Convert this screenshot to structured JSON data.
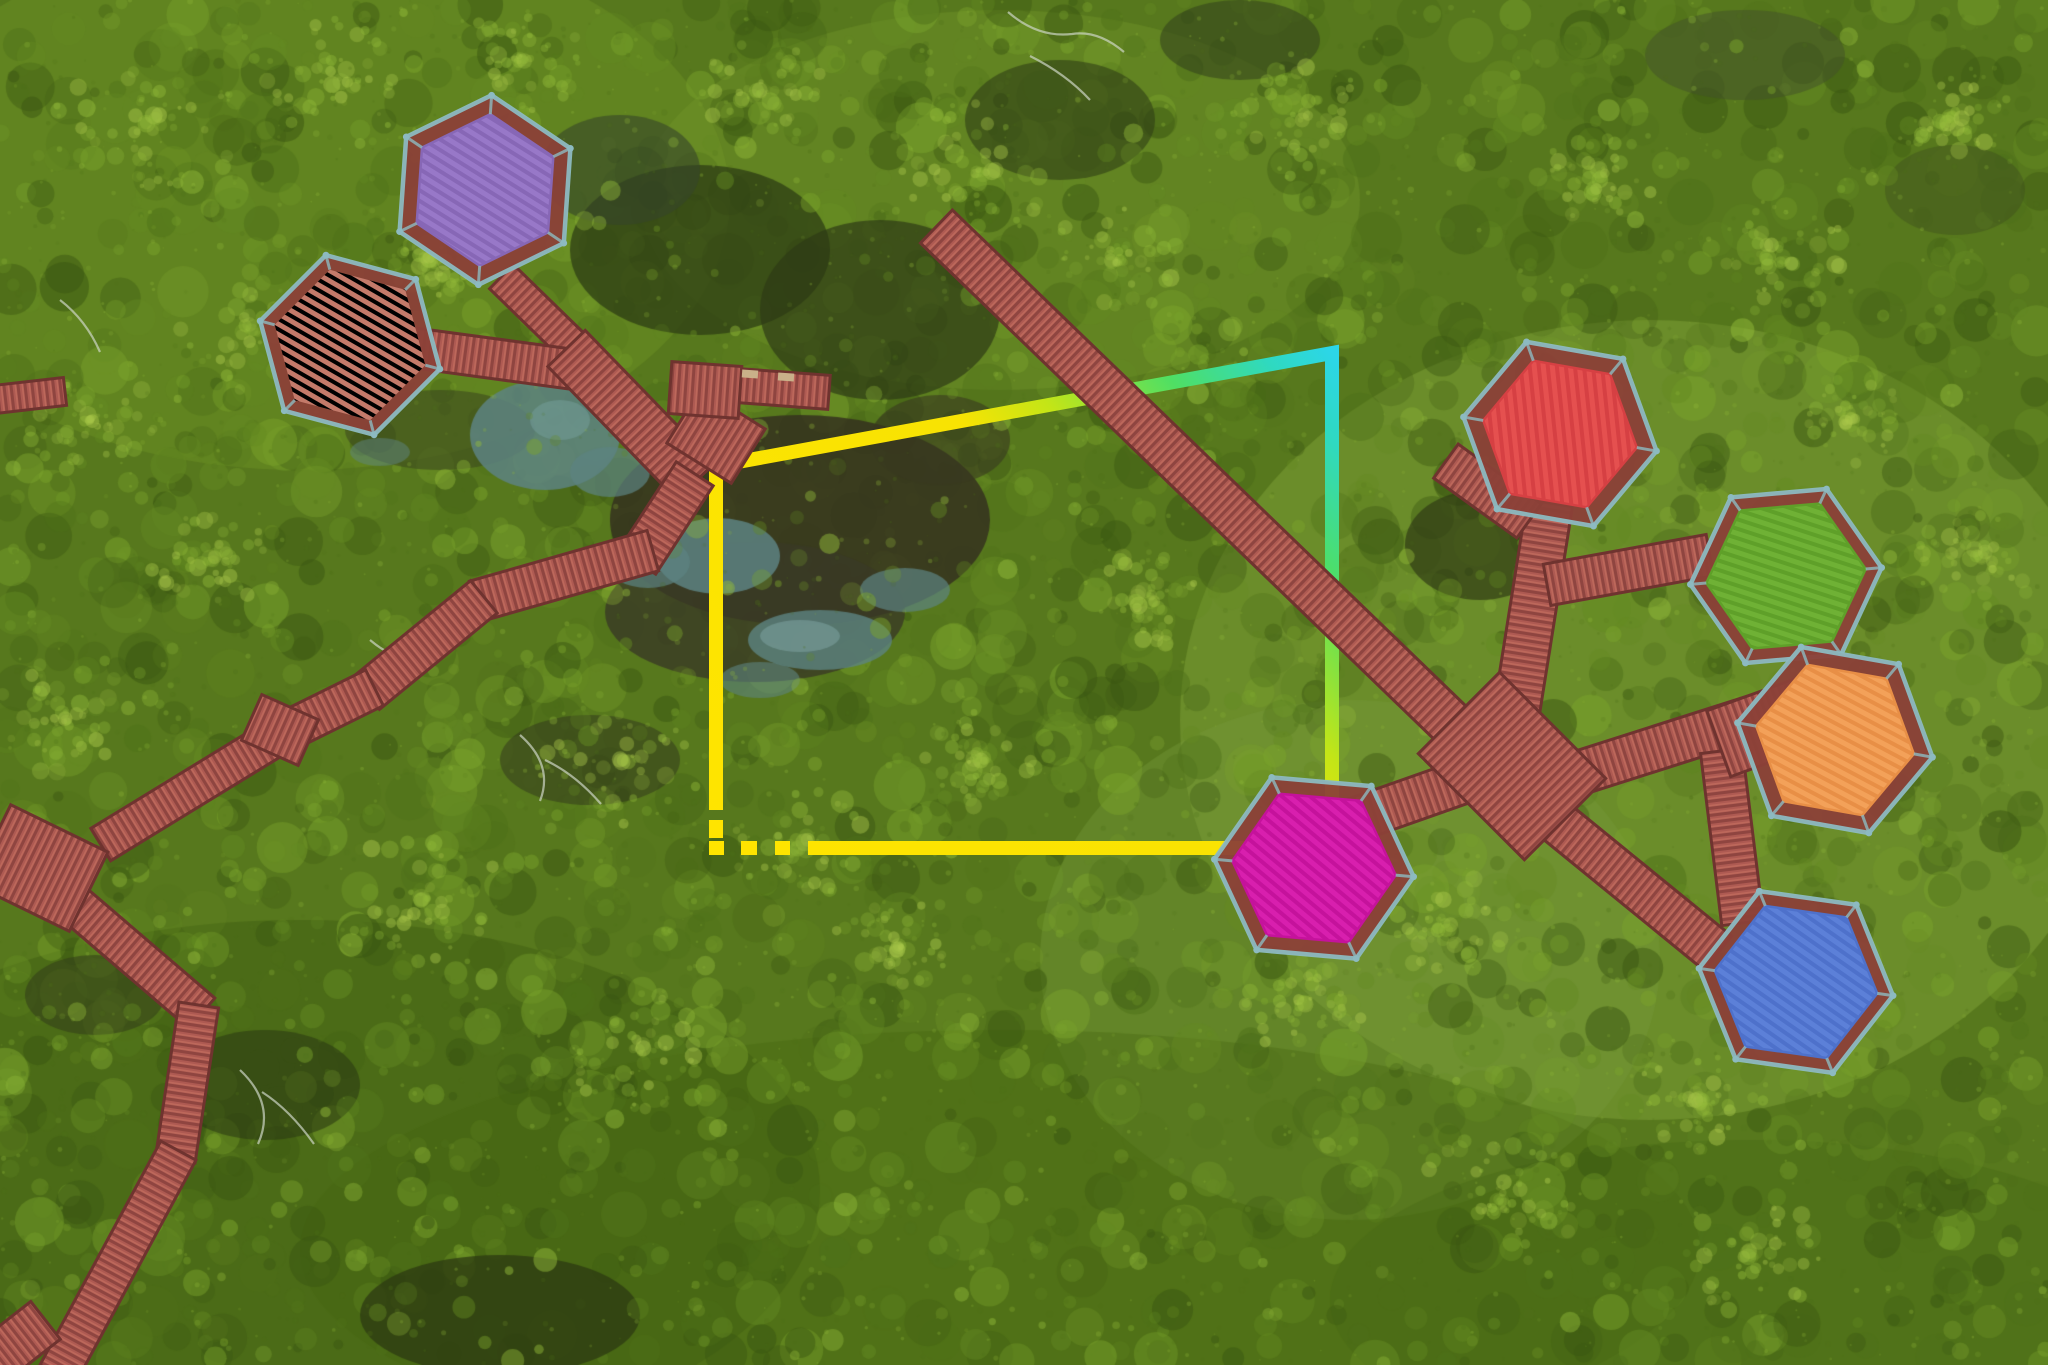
{
  "scene": {
    "type": "aerial-drone-photo",
    "subject": "Mangrove forest park with seven hexagonal viewing pavilions connected by red wooden boardwalks, partially outlined by a yellow-to-cyan selection rectangle",
    "width": 2048,
    "height": 1365
  },
  "annotation": {
    "shape": "rectangle-outline",
    "stroke_width": 14,
    "solid_path": "M 716,810 L 716,466 L 1332,353 L 1332,812",
    "corner_dash": {
      "x": 709,
      "y": 820,
      "w": 14,
      "h": 18
    },
    "dashed_path": "M 709,848 L 1252,848",
    "dash_pattern": "15 17 16 18 15 18 600",
    "gradient": {
      "from": [
        716,
        848
      ],
      "to": [
        1332,
        353
      ],
      "stops": [
        [
          0.0,
          "#ffe400"
        ],
        [
          0.58,
          "#f8e303"
        ],
        [
          0.68,
          "#c3e517"
        ],
        [
          0.82,
          "#4fdf64"
        ],
        [
          0.93,
          "#2fd9c0"
        ],
        [
          1.0,
          "#2cd6e8"
        ]
      ]
    }
  },
  "pavilions": [
    {
      "id": "purple",
      "roof_color": "#9878c8",
      "stripe_color": "#8767b6"
    },
    {
      "id": "salmon",
      "roof_color": "#c47a6a",
      "stripe_color": "#b16а5c"
    },
    {
      "id": "red",
      "roof_color": "#e5504f",
      "stripe_color": "#d64043"
    },
    {
      "id": "green",
      "roof_color": "#6fb135",
      "stripe_color": "#5fa029"
    },
    {
      "id": "orange",
      "roof_color": "#f3a159",
      "stripe_color": "#e88f46"
    },
    {
      "id": "magenta",
      "roof_color": "#d81fae",
      "stripe_color": "#c5129c"
    },
    {
      "id": "blue",
      "roof_color": "#5c80d8",
      "stripe_color": "#4e71cb"
    }
  ],
  "boardwalk": {
    "color": "#ae5a52",
    "stripe_dark": "#8f4540",
    "stripe_light": "#c16b5e",
    "edge_color": "#6f332f",
    "deck_color": "#8c4138",
    "railing_color": "#8dbac1",
    "bench_color": "#c9b089"
  },
  "canopy": {
    "base": "#57781d",
    "palette": [
      "#3a5612",
      "#4e7019",
      "#648a22",
      "#7ba42c",
      "#93bb3a",
      "#aecb4d"
    ],
    "grass_tint": "#7da23a",
    "mud_color": "#36321f",
    "water_color": "#5d8381",
    "dead_branch_color": "#cdd5c6"
  }
}
